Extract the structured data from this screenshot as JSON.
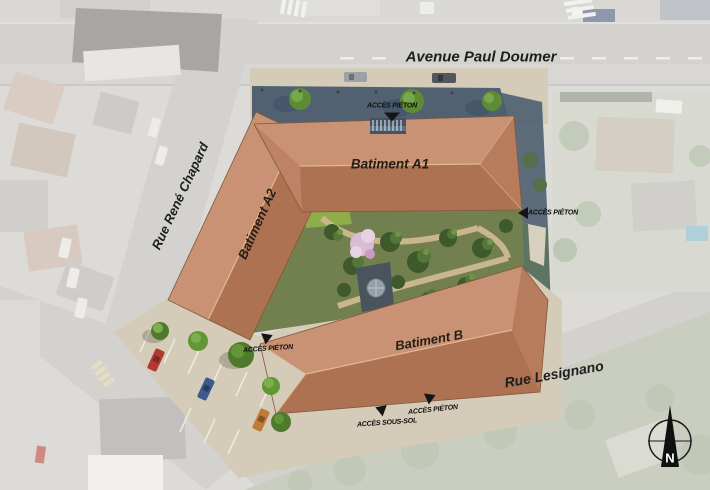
{
  "plan": {
    "streets": {
      "avenue": "Avenue Paul Doumer",
      "rue_chapard": "Rue René Chapard",
      "rue_lesignano": "Rue Lesignano"
    },
    "buildings": {
      "a1": "Batiment A1",
      "a2": "Batiment A2",
      "b": "Batiment B"
    },
    "access": {
      "pieton_top": "ACCÈS PIÉTON",
      "pieton_east": "ACCÈS PIÉTON",
      "pieton_west": "ACCÈS PIÉTON",
      "pieton_south": "ACCÈS PIÉTON",
      "sous_sol": "ACCÈS SOUS-SOL"
    },
    "compass": {
      "north": "N"
    },
    "palette": {
      "roof": "#bd8364",
      "roof_light": "#c99274",
      "roof_dark": "#ad7252",
      "shadow_blue": "#47586b",
      "sidewalk": "#d5cbb9",
      "courtyard_green": "#72804f",
      "road_gray": "#b9b7b2",
      "tree_green": "#5d8c35"
    }
  }
}
